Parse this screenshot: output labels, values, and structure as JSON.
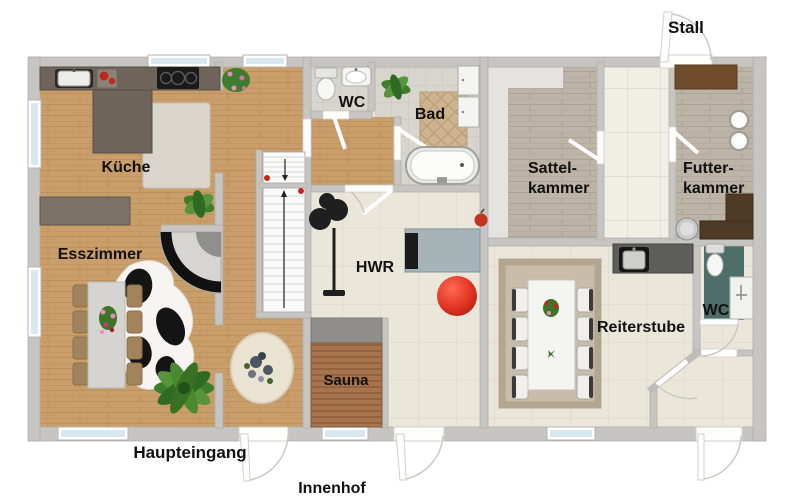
{
  "floorplan": {
    "rooms": {
      "kueche": {
        "label": "Küche"
      },
      "esszimmer": {
        "label": "Esszimmer"
      },
      "wc_haus": {
        "label": "WC"
      },
      "bad": {
        "label": "Bad"
      },
      "hwr": {
        "label": "HWR"
      },
      "sauna": {
        "label": "Sauna"
      },
      "sattelkammer": {
        "label_line1": "Sattel-",
        "label_line2": "kammer"
      },
      "futterkammer": {
        "label_line1": "Futter-",
        "label_line2": "kammer"
      },
      "reiterstube": {
        "label": "Reiterstube"
      },
      "wc_stall": {
        "label": "WC"
      }
    },
    "exterior_labels": {
      "stall": "Stall",
      "haupteingang": "Haupteingang",
      "innenhof": "Innenhof"
    },
    "colors": {
      "wall": "#c6c5c2",
      "wood_floor": "#c99e6a",
      "gray_wood_floor": "#bcb4a6",
      "tile_cream": "#eae6da",
      "tile_gray": "#d8d5ce",
      "tile_corridor": "#f1eee6",
      "counter_dark": "#6e6459",
      "sideboard": "#7b7265",
      "stable_counter_brown": "#4f3a26",
      "sauna_wood": "#a8744e",
      "bench_gray": "#8f8e8a",
      "red_ball": "#d6301c",
      "teal_mat": "#4e6e6a",
      "window_glass": "#d9e8ef",
      "bath_rug": "#cdb48e",
      "reiterstube_rug": "#c7bda8",
      "plant_green": "#4a8a32"
    }
  }
}
